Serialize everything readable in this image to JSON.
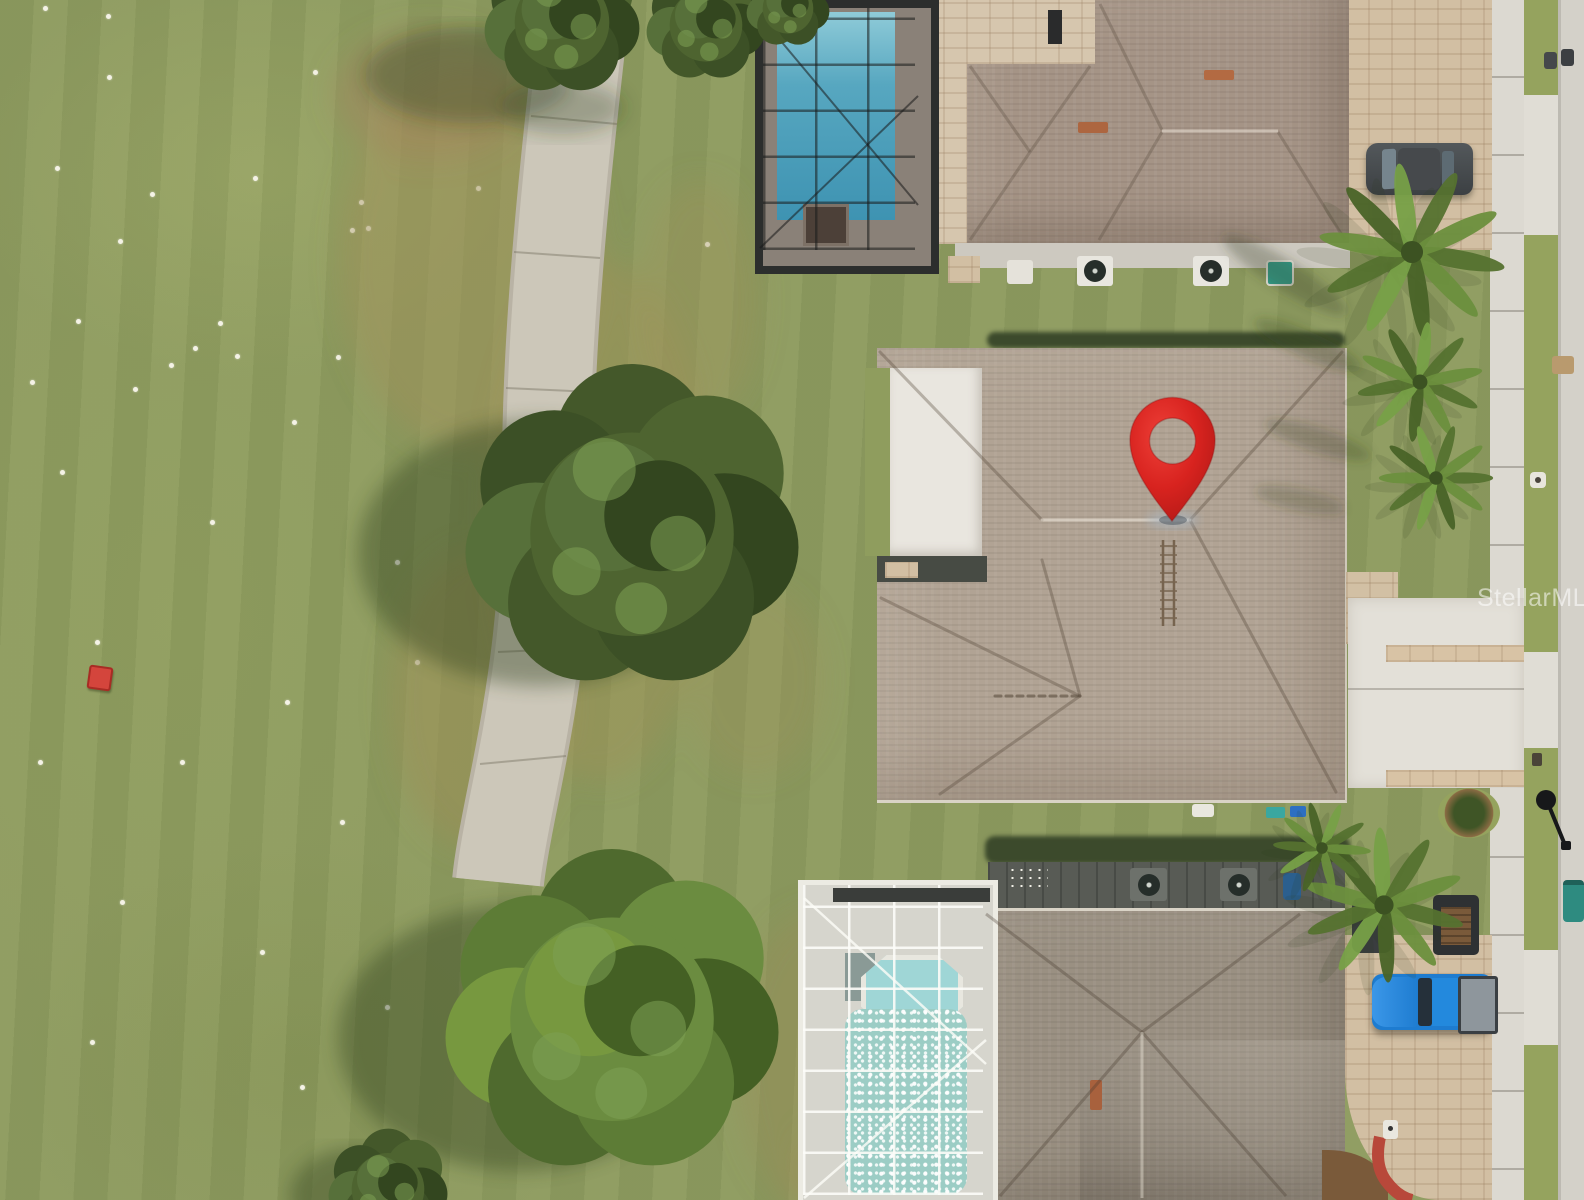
{
  "watermark": {
    "text": "StellarMLS"
  },
  "marker": {
    "name": "location-pin",
    "color": "#d8231f",
    "shadow": "map-pin-drop-shadow"
  },
  "scene": {
    "type": "aerial-drone-photo",
    "setting": "residential homes backing onto golf course fairway",
    "objects": [
      "golf-course-fairway",
      "golf-balls",
      "red-range-marker",
      "cart-path",
      "oak-tree",
      "top-house",
      "top-house-screened-pool",
      "subject-house-roof",
      "location-pin",
      "roof-ladder",
      "palm-trees",
      "bottom-house",
      "bottom-house-screened-pool",
      "blue-pickup-truck",
      "utility-trailer",
      "gray-car",
      "sidewalk",
      "street",
      "paver-driveways",
      "street-lamp",
      "trash-bins"
    ],
    "colors": {
      "fairway_grass": "#8d9a60",
      "cart_path": "#ccc7b9",
      "top_pool_water": "#57a7c0",
      "enclosure_frame_dark": "#2c2e2d",
      "enclosure_frame_white": "#ecebe3",
      "roof_top_house": "#a59486",
      "roof_subject_house": "#b1a394",
      "roof_bottom_house": "#9a9082",
      "pavers": "#d2bfa3",
      "sidewalk": "#dcd9d1",
      "road": "#d4d1c9",
      "pin_red": "#d8231f",
      "truck_blue": "#1e7cd0",
      "sparkle_pool": "#9ccdc5"
    }
  }
}
